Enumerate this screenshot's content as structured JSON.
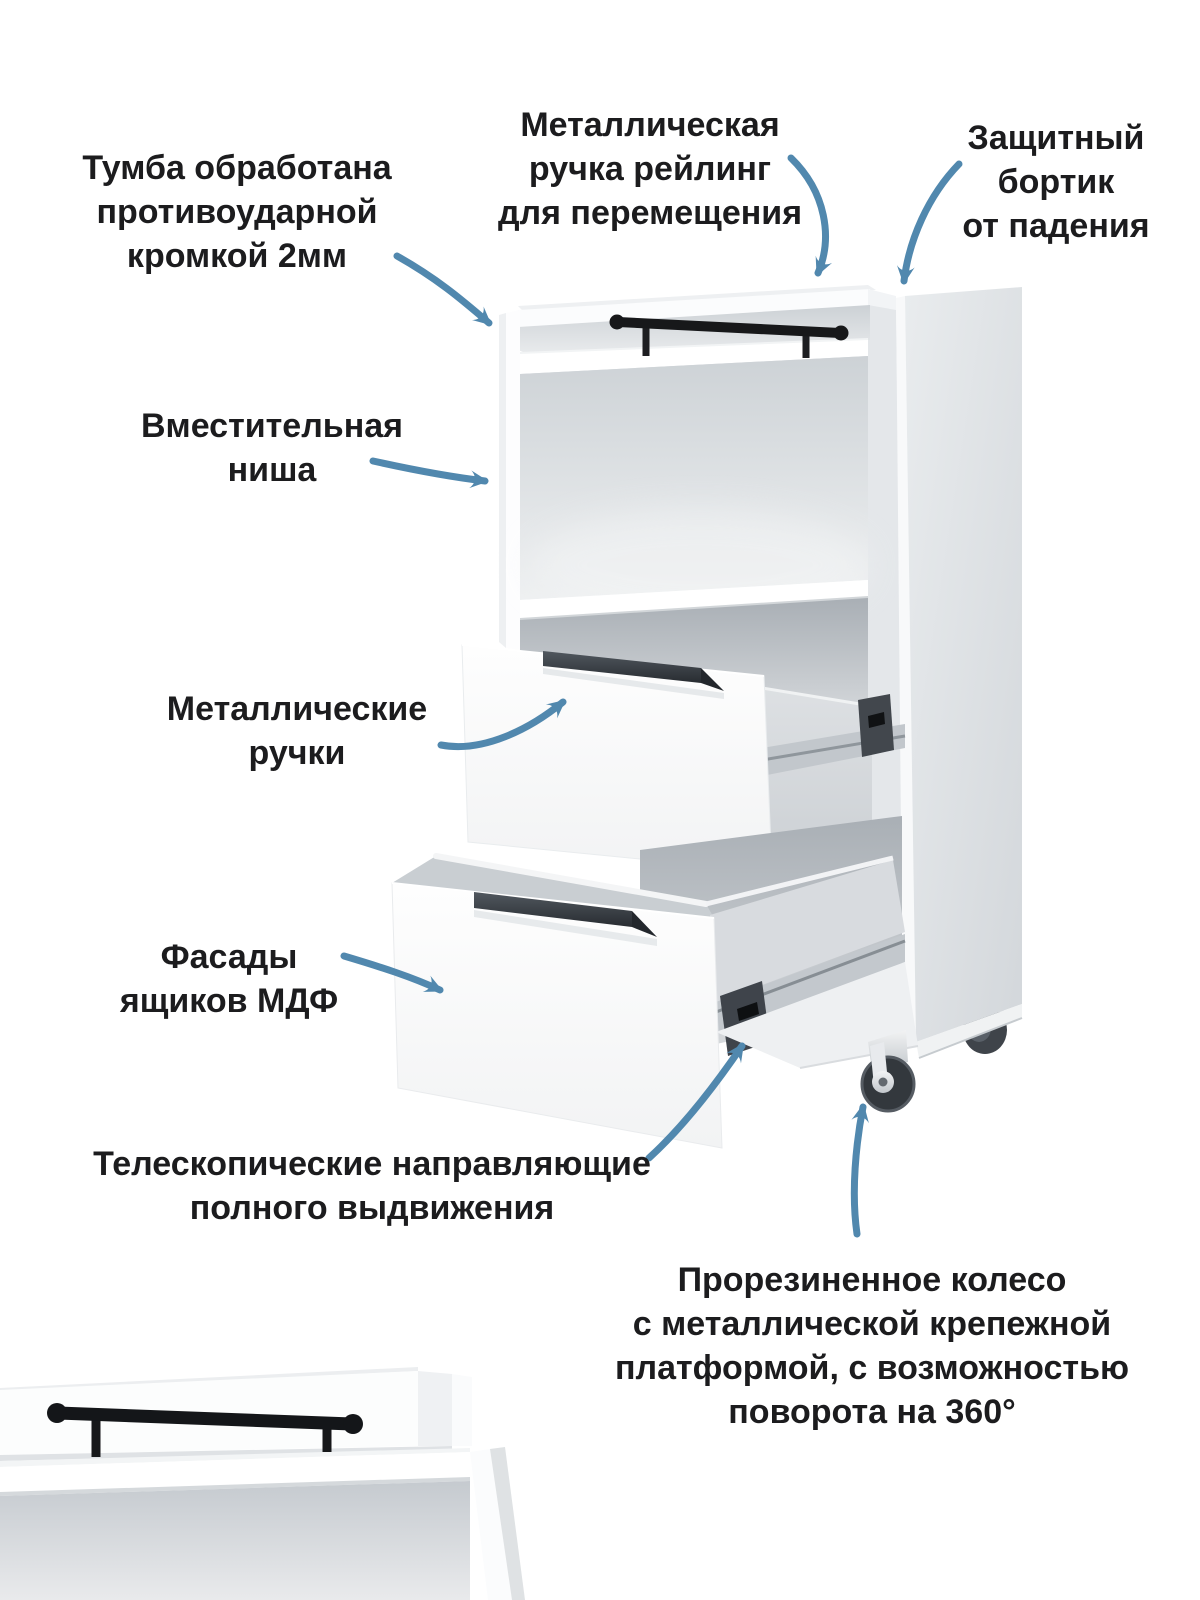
{
  "colors": {
    "text": "#1c1c1e",
    "arrow": "#5188ae",
    "furniture_white": "#ffffff",
    "furniture_gray": "#dcdfe2",
    "handle_black": "#17181a",
    "drawer_handle_gray": "#3a4046",
    "wheel_dark": "#33383d"
  },
  "annotations": {
    "edge_protection": {
      "lines": [
        "Тумба обработана",
        "противоударной",
        "кромкой 2мм"
      ]
    },
    "rail_handle": {
      "lines": [
        "Металлическая",
        "ручка рейлинг",
        "для перемещения"
      ]
    },
    "fall_rim": {
      "lines": [
        "Защитный",
        "бортик",
        "от падения"
      ]
    },
    "niche": {
      "lines": [
        "Вместительная",
        "ниша"
      ]
    },
    "metal_handles": {
      "lines": [
        "Металлические",
        "ручки"
      ]
    },
    "drawer_fronts": {
      "lines": [
        "Фасады",
        "ящиков МДФ"
      ]
    },
    "telescopic_slides": {
      "lines": [
        "Телескопические направляющие",
        "полного выдвижения"
      ]
    },
    "wheel": {
      "lines": [
        "Прорезиненное колесо",
        "с металлической крепежной",
        "платформой, с возможностью",
        "поворота на 360°"
      ]
    }
  }
}
